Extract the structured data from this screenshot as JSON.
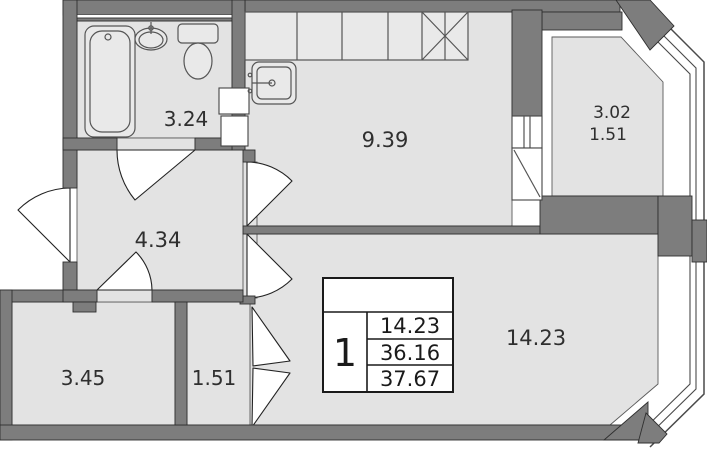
{
  "floor_plan": {
    "title": "1-room apartment plan",
    "rooms": {
      "bathroom": {
        "name": "bathroom",
        "area": "3.24"
      },
      "kitchen": {
        "name": "kitchen",
        "area": "9.39"
      },
      "balcony": {
        "name": "balcony",
        "area_full": "3.02",
        "area_reduced": "1.51"
      },
      "hall": {
        "name": "hallway",
        "area": "4.34"
      },
      "living": {
        "name": "living room",
        "area": "14.23"
      },
      "storage": {
        "name": "storage room",
        "area": "3.45"
      },
      "wardrobe": {
        "name": "wardrobe",
        "area": "1.51"
      }
    },
    "summary": {
      "rooms_count": "1",
      "living_area": "14.23",
      "apartment_area": "36.16",
      "total_area": "37.67"
    },
    "colors": {
      "floor": "#e3e3e3",
      "wall": "#7d7d7d",
      "outline": "#2f2f2f",
      "label": "#2f2f2f"
    },
    "fixtures": [
      "bathtub",
      "washbasin",
      "toilet",
      "kitchen-counter",
      "stove",
      "kitchen-sink",
      "folding-door"
    ]
  }
}
